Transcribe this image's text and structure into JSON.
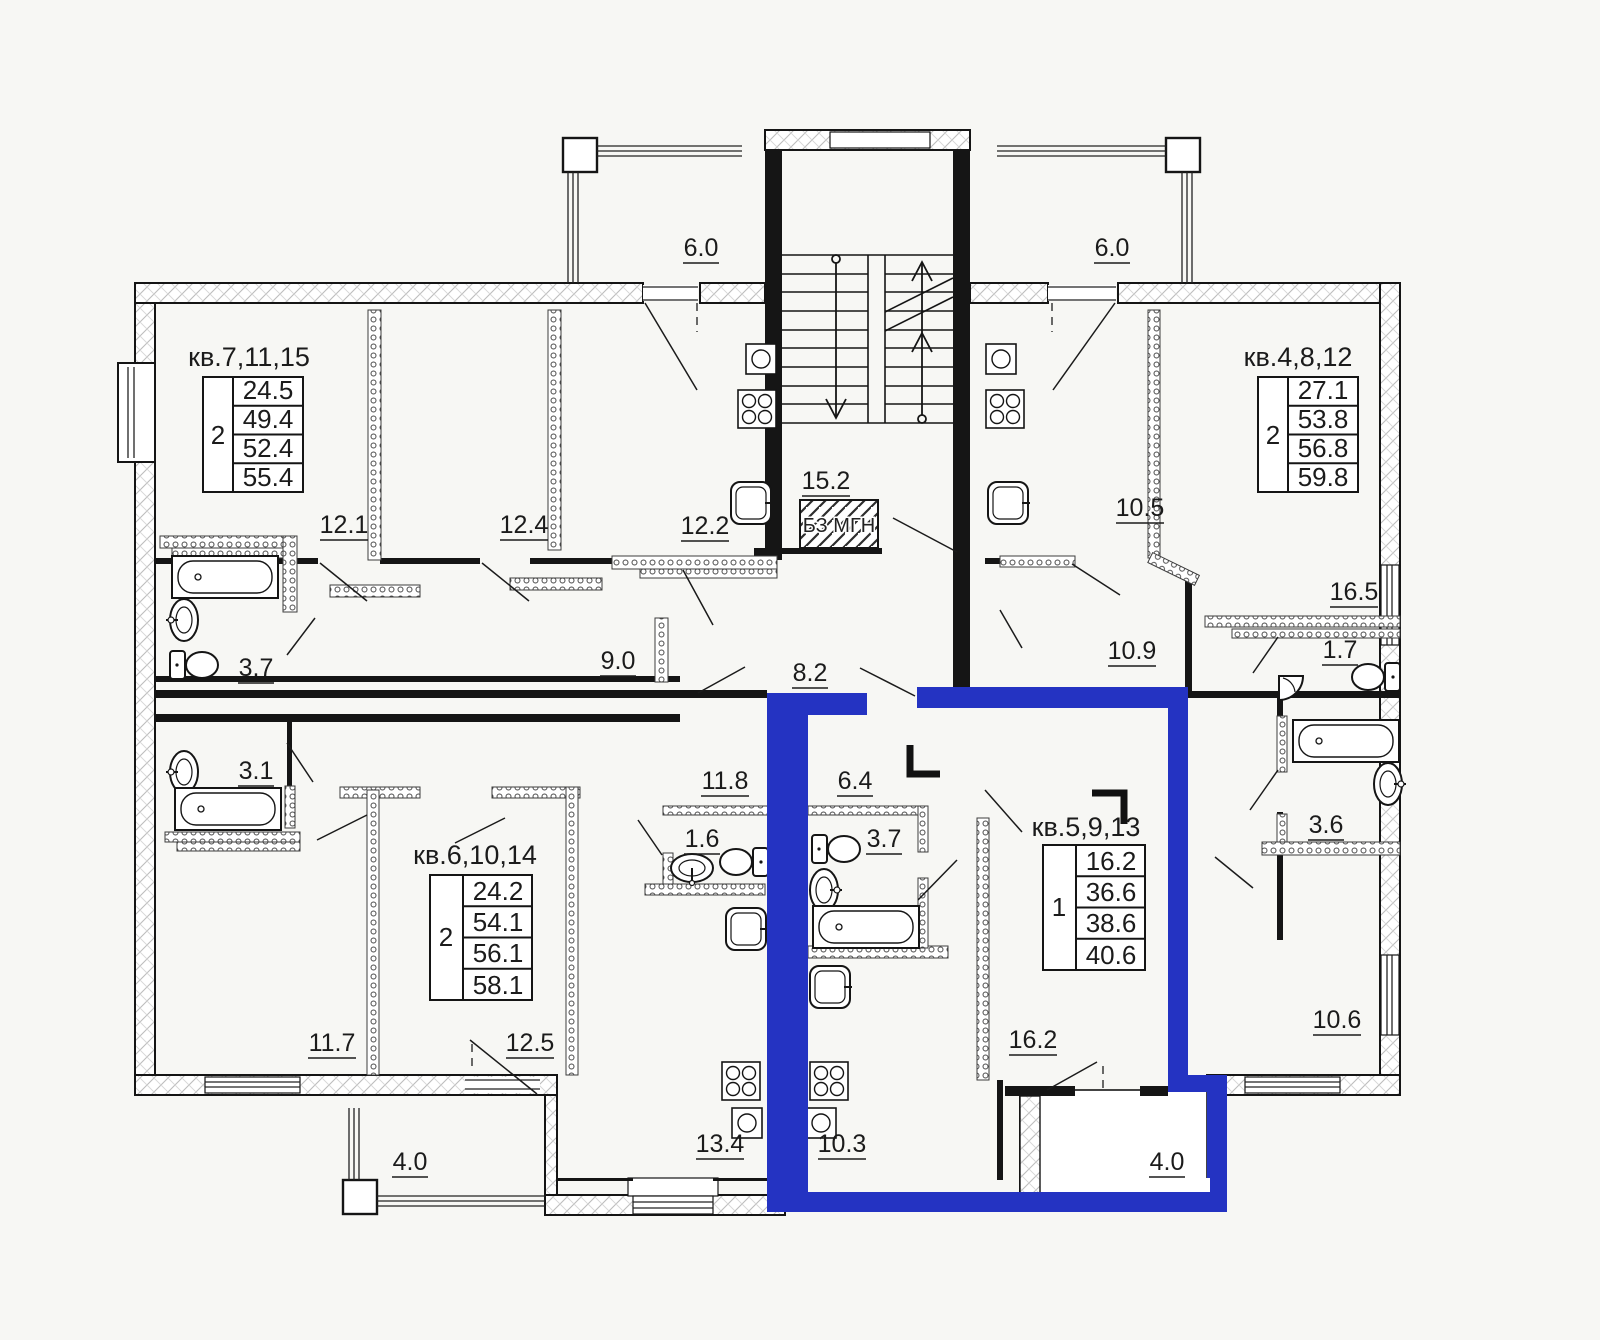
{
  "plan": {
    "highlight_color": "#2433c2",
    "wall_color": "#151515",
    "background": "#f7f7f4",
    "safe_zone_label": "БЗ МГН",
    "apartments": [
      {
        "id": "kv7",
        "title": "кв.7,11,15",
        "rooms": "2",
        "areas": [
          "24.5",
          "49.4",
          "52.4",
          "55.4"
        ],
        "highlighted": false
      },
      {
        "id": "kv4",
        "title": "кв.4,8,12",
        "rooms": "2",
        "areas": [
          "27.1",
          "53.8",
          "56.8",
          "59.8"
        ],
        "highlighted": false
      },
      {
        "id": "kv6",
        "title": "кв.6,10,14",
        "rooms": "2",
        "areas": [
          "24.2",
          "54.1",
          "56.1",
          "58.1"
        ],
        "highlighted": false
      },
      {
        "id": "kv5",
        "title": "кв.5,9,13",
        "rooms": "1",
        "areas": [
          "16.2",
          "36.6",
          "38.6",
          "40.6"
        ],
        "highlighted": true
      }
    ],
    "labels": {
      "b60l": "6.0",
      "b60r": "6.0",
      "b40l": "4.0",
      "b40r": "4.0",
      "s152": "15.2",
      "bz": "БЗ МГН",
      "r121": "12.1",
      "r124": "12.4",
      "r122": "12.2",
      "r105": "10.5",
      "r165": "16.5",
      "r37a": "3.7",
      "r90": "9.0",
      "r82": "8.2",
      "r109": "10.9",
      "r17": "1.7",
      "r31": "3.1",
      "r118": "11.8",
      "r64": "6.4",
      "r16": "1.6",
      "r37b": "3.7",
      "r36": "3.6",
      "r117": "11.7",
      "r125": "12.5",
      "r162": "16.2",
      "r106": "10.6",
      "r134": "13.4",
      "r103": "10.3"
    }
  }
}
